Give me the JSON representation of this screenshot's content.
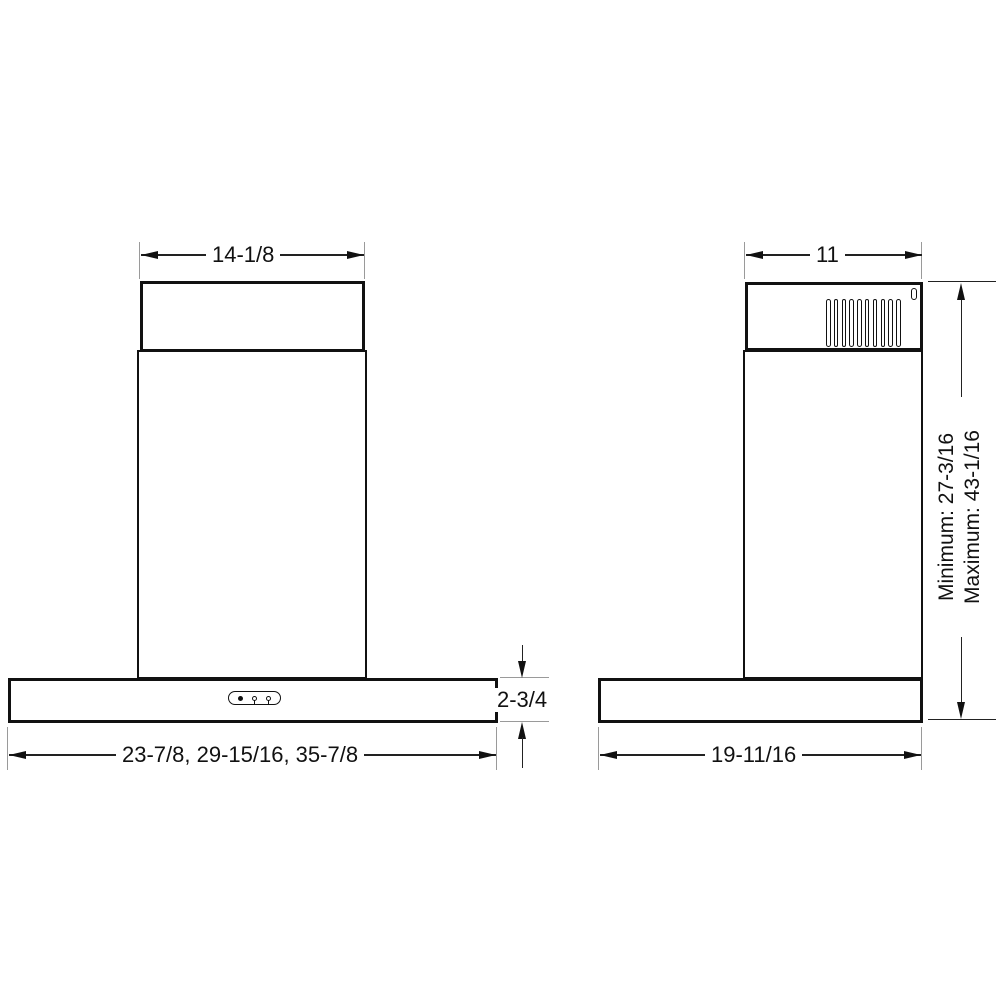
{
  "front_view": {
    "chimney_top_width": "14-1/8",
    "body_width_options": "23-7/8, 29-15/16, 35-7/8",
    "canopy_height": "2-3/4"
  },
  "side_view": {
    "chimney_depth": "11",
    "canopy_depth": "19-11/16",
    "height_minimum": "Minimum: 27-3/16",
    "height_maximum": "Maximum: 43-1/16",
    "vent_slat_count": 10
  },
  "colors": {
    "object_line": "#111111",
    "dimension_line": "#222222",
    "extension_line": "#9a9a9a",
    "background": "#ffffff"
  }
}
